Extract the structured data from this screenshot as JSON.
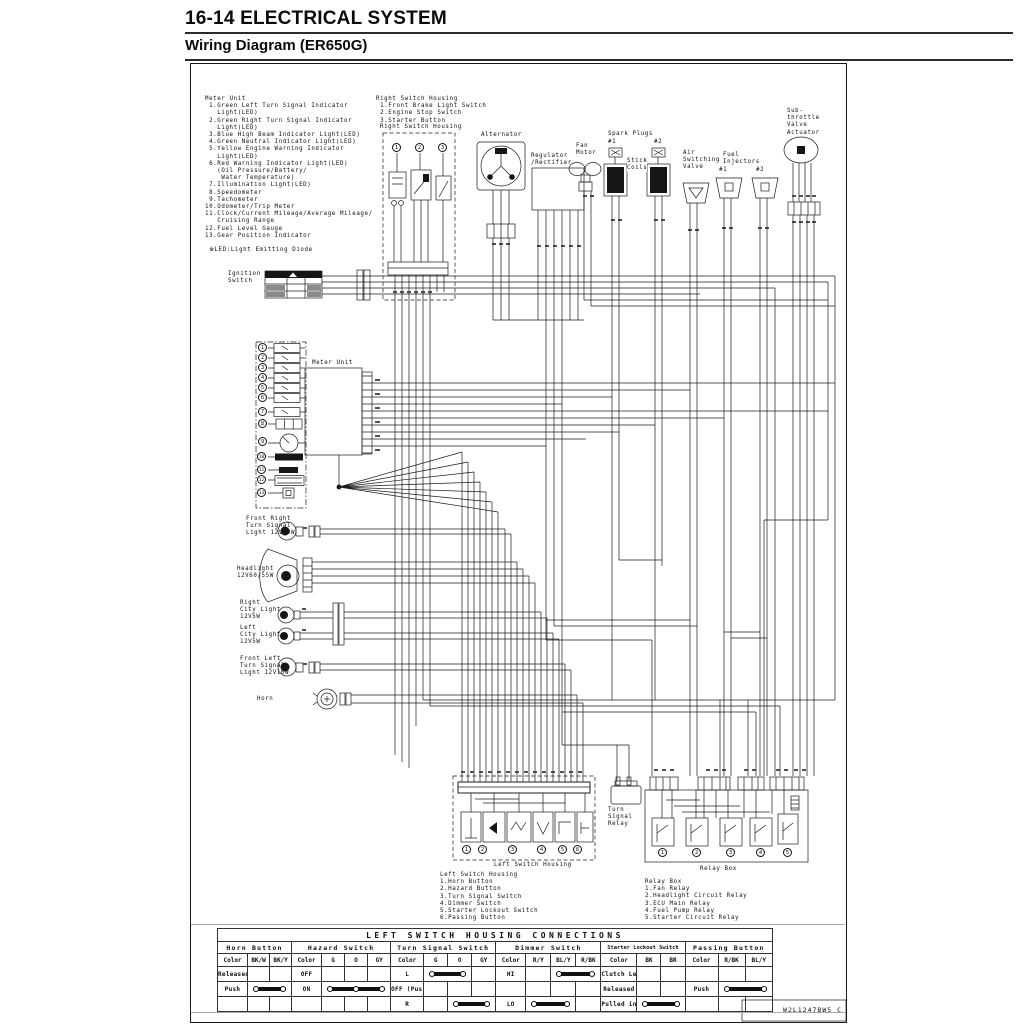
{
  "header": {
    "title": "16-14 ELECTRICAL SYSTEM",
    "subtitle": "Wiring Diagram (ER650G)"
  },
  "footer": {
    "part_number": "W2L1247BW5 C"
  },
  "legends": {
    "meter_unit": "Meter Unit\n 1.Green Left Turn Signal Indicator\n   Light(LED)\n 2.Green Right Turn Signal Indicator\n   Light(LED)\n 3.Blue High Beam Indicator Light(LED)\n 4.Green Neutral Indicator Light(LED)\n 5.Yellow Engine Warning Indicator\n   Light(LED)\n 6.Red Warning Indicator Light(LED)\n   (Oil Pressure/Battery/\n    Water Temperature)\n 7.Illumination Light(LED)\n 8.Speedometer\n 9.Tachometer\n10.Odometer/Trip Meter\n11.Clock/Current Mileage/Average Mileage/\n   Cruising Range\n12.Fuel Level Gauge\n13.Gear Position Indicator\n\n ※LED:Light Emitting Diode",
    "right_switch_housing": "Right Switch Housing\n 1.Front Brake Light Switch\n 2.Engine Stop Switch\n 3.Starter Button",
    "left_switch_housing": "Left Switch Housing\n1.Horn Button\n2.Hazard Button\n3.Turn Signal Switch\n4.Dimmer Switch\n5.Starter Lockout Switch\n6.Passing Button",
    "relay_box": "Relay Box\n1.Fan Relay\n2.Headlight Circuit Relay\n3.ECU Main Relay\n4.Fuel Pump Relay\n5.Starter Circuit Relay"
  },
  "components": {
    "right_switch_housing_box": "Right Switch Housing",
    "alternator": "Alternator",
    "regulator": "Regulator\n/Rectifier",
    "fan_motor": "Fan\nMotor",
    "spark_plugs": "Spark Plugs",
    "spark_plug_1": "#1",
    "spark_plug_2": "#2",
    "stick_coils": "Stick\nCoils",
    "air_switching_valve": "Air\nSwitching\nValve",
    "fuel_injectors": "Fuel\nInjectors",
    "injector_1": "#1",
    "injector_2": "#2",
    "sub_throttle": "Sub-\nthrottle\nValve\nActuator",
    "ignition_switch": "Ignition\nSwitch",
    "meter_unit": "Meter Unit",
    "front_right_turn_signal": "Front Right\nTurn Signal\nLight 12V10W",
    "headlight": "Headlight\n12V60/55W",
    "right_city_light": "Right\nCity Light\n12V5W",
    "left_city_light": "Left\nCity Light\n12V5W",
    "front_left_turn_signal": "Front Left\nTurn Signal\nLight 12V10W",
    "horn": "Horn",
    "left_switch_housing_caption": "Left Switch Housing",
    "turn_signal_relay": "Turn\nSignal\nRelay",
    "relay_box_caption": "Relay Box"
  },
  "callouts": {
    "right_switch_housing": [
      "1",
      "2",
      "3"
    ],
    "meter_unit": [
      "1",
      "2",
      "3",
      "4",
      "5",
      "6",
      "7",
      "8",
      "9",
      "10",
      "11",
      "12",
      "13"
    ],
    "left_switch_housing": [
      "1",
      "2",
      "3",
      "4",
      "5",
      "6"
    ],
    "relay_box": [
      "1",
      "2",
      "3",
      "4",
      "5"
    ]
  },
  "table": {
    "title": "LEFT SWITCH HOUSING CONNECTIONS",
    "color_header": "Color",
    "sections": {
      "horn": {
        "title": "Horn Button",
        "c1": "BK/W",
        "c2": "BK/Y",
        "r1": "Released",
        "r2": "Push"
      },
      "hazard": {
        "title": "Hazard Switch",
        "c1": "G",
        "c2": "O",
        "c3": "GY",
        "r1": "OFF",
        "r2": "ON"
      },
      "turn": {
        "title": "Turn Signal Switch",
        "c1": "G",
        "c2": "O",
        "c3": "GY",
        "r1": "L",
        "r2": "OFF (Push)",
        "r3": "R"
      },
      "dimmer": {
        "title": "Dimmer Switch",
        "c1": "R/Y",
        "c2": "BL/Y",
        "c3": "R/BK",
        "r1": "HI",
        "r3": "LO"
      },
      "starter": {
        "title": "Starter Lockout Switch",
        "c1": "BK",
        "c2": "BR",
        "r1": "Clutch Lever",
        "r2": "Released",
        "r3": "Pulled in"
      },
      "passing": {
        "title": "Passing Button",
        "c1": "R/BK",
        "c2": "BL/Y",
        "r2": "Push"
      }
    }
  }
}
